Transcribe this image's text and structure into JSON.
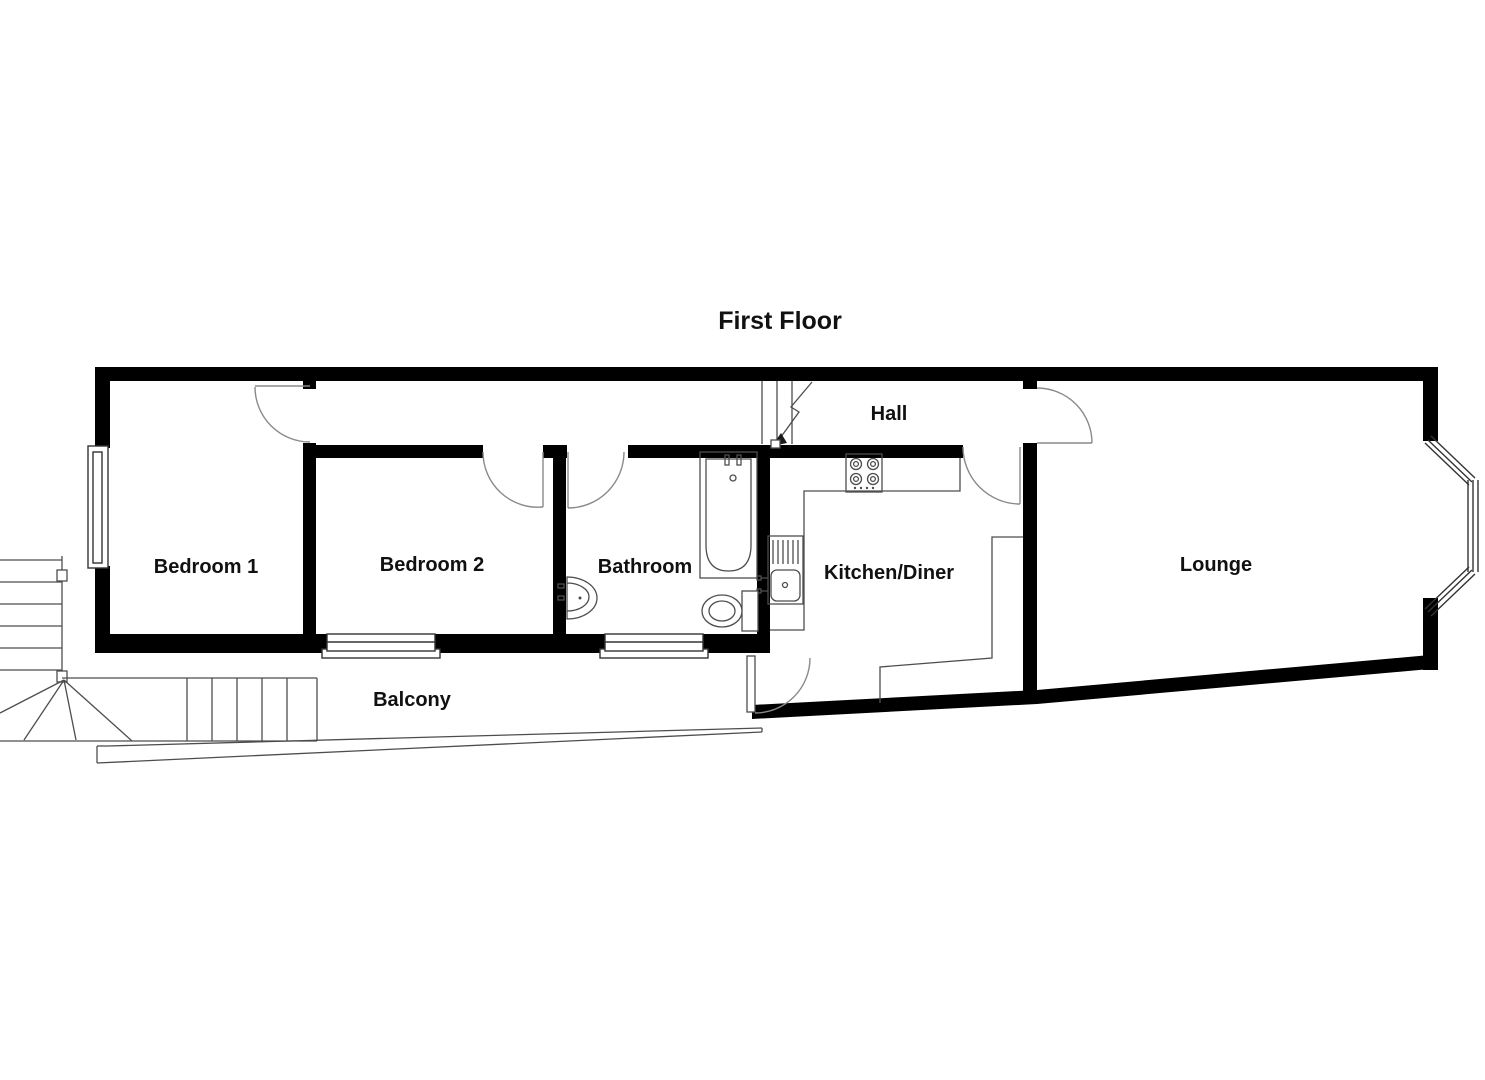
{
  "title": "First Floor",
  "rooms": {
    "bedroom1": {
      "label": "Bedroom 1"
    },
    "bedroom2": {
      "label": "Bedroom 2"
    },
    "bathroom": {
      "label": "Bathroom"
    },
    "kitchen_diner": {
      "label": "Kitchen/Diner"
    },
    "hall": {
      "label": "Hall"
    },
    "lounge": {
      "label": "Lounge"
    },
    "balcony": {
      "label": "Balcony"
    }
  },
  "fixtures": [
    "bathtub",
    "toilet",
    "wash-basin",
    "kitchen-sink-with-drainer",
    "hob-4-burner",
    "kitchen-worktop",
    "internal-stairs-down-arrow",
    "external-balcony-stairs",
    "bay-window",
    "windows",
    "door-swings"
  ],
  "colors": {
    "walls": "#000000",
    "fixture_lines": "#4d4d4d",
    "door_arcs": "#8a8a8a",
    "background": "#ffffff",
    "label_text": "#111111"
  }
}
